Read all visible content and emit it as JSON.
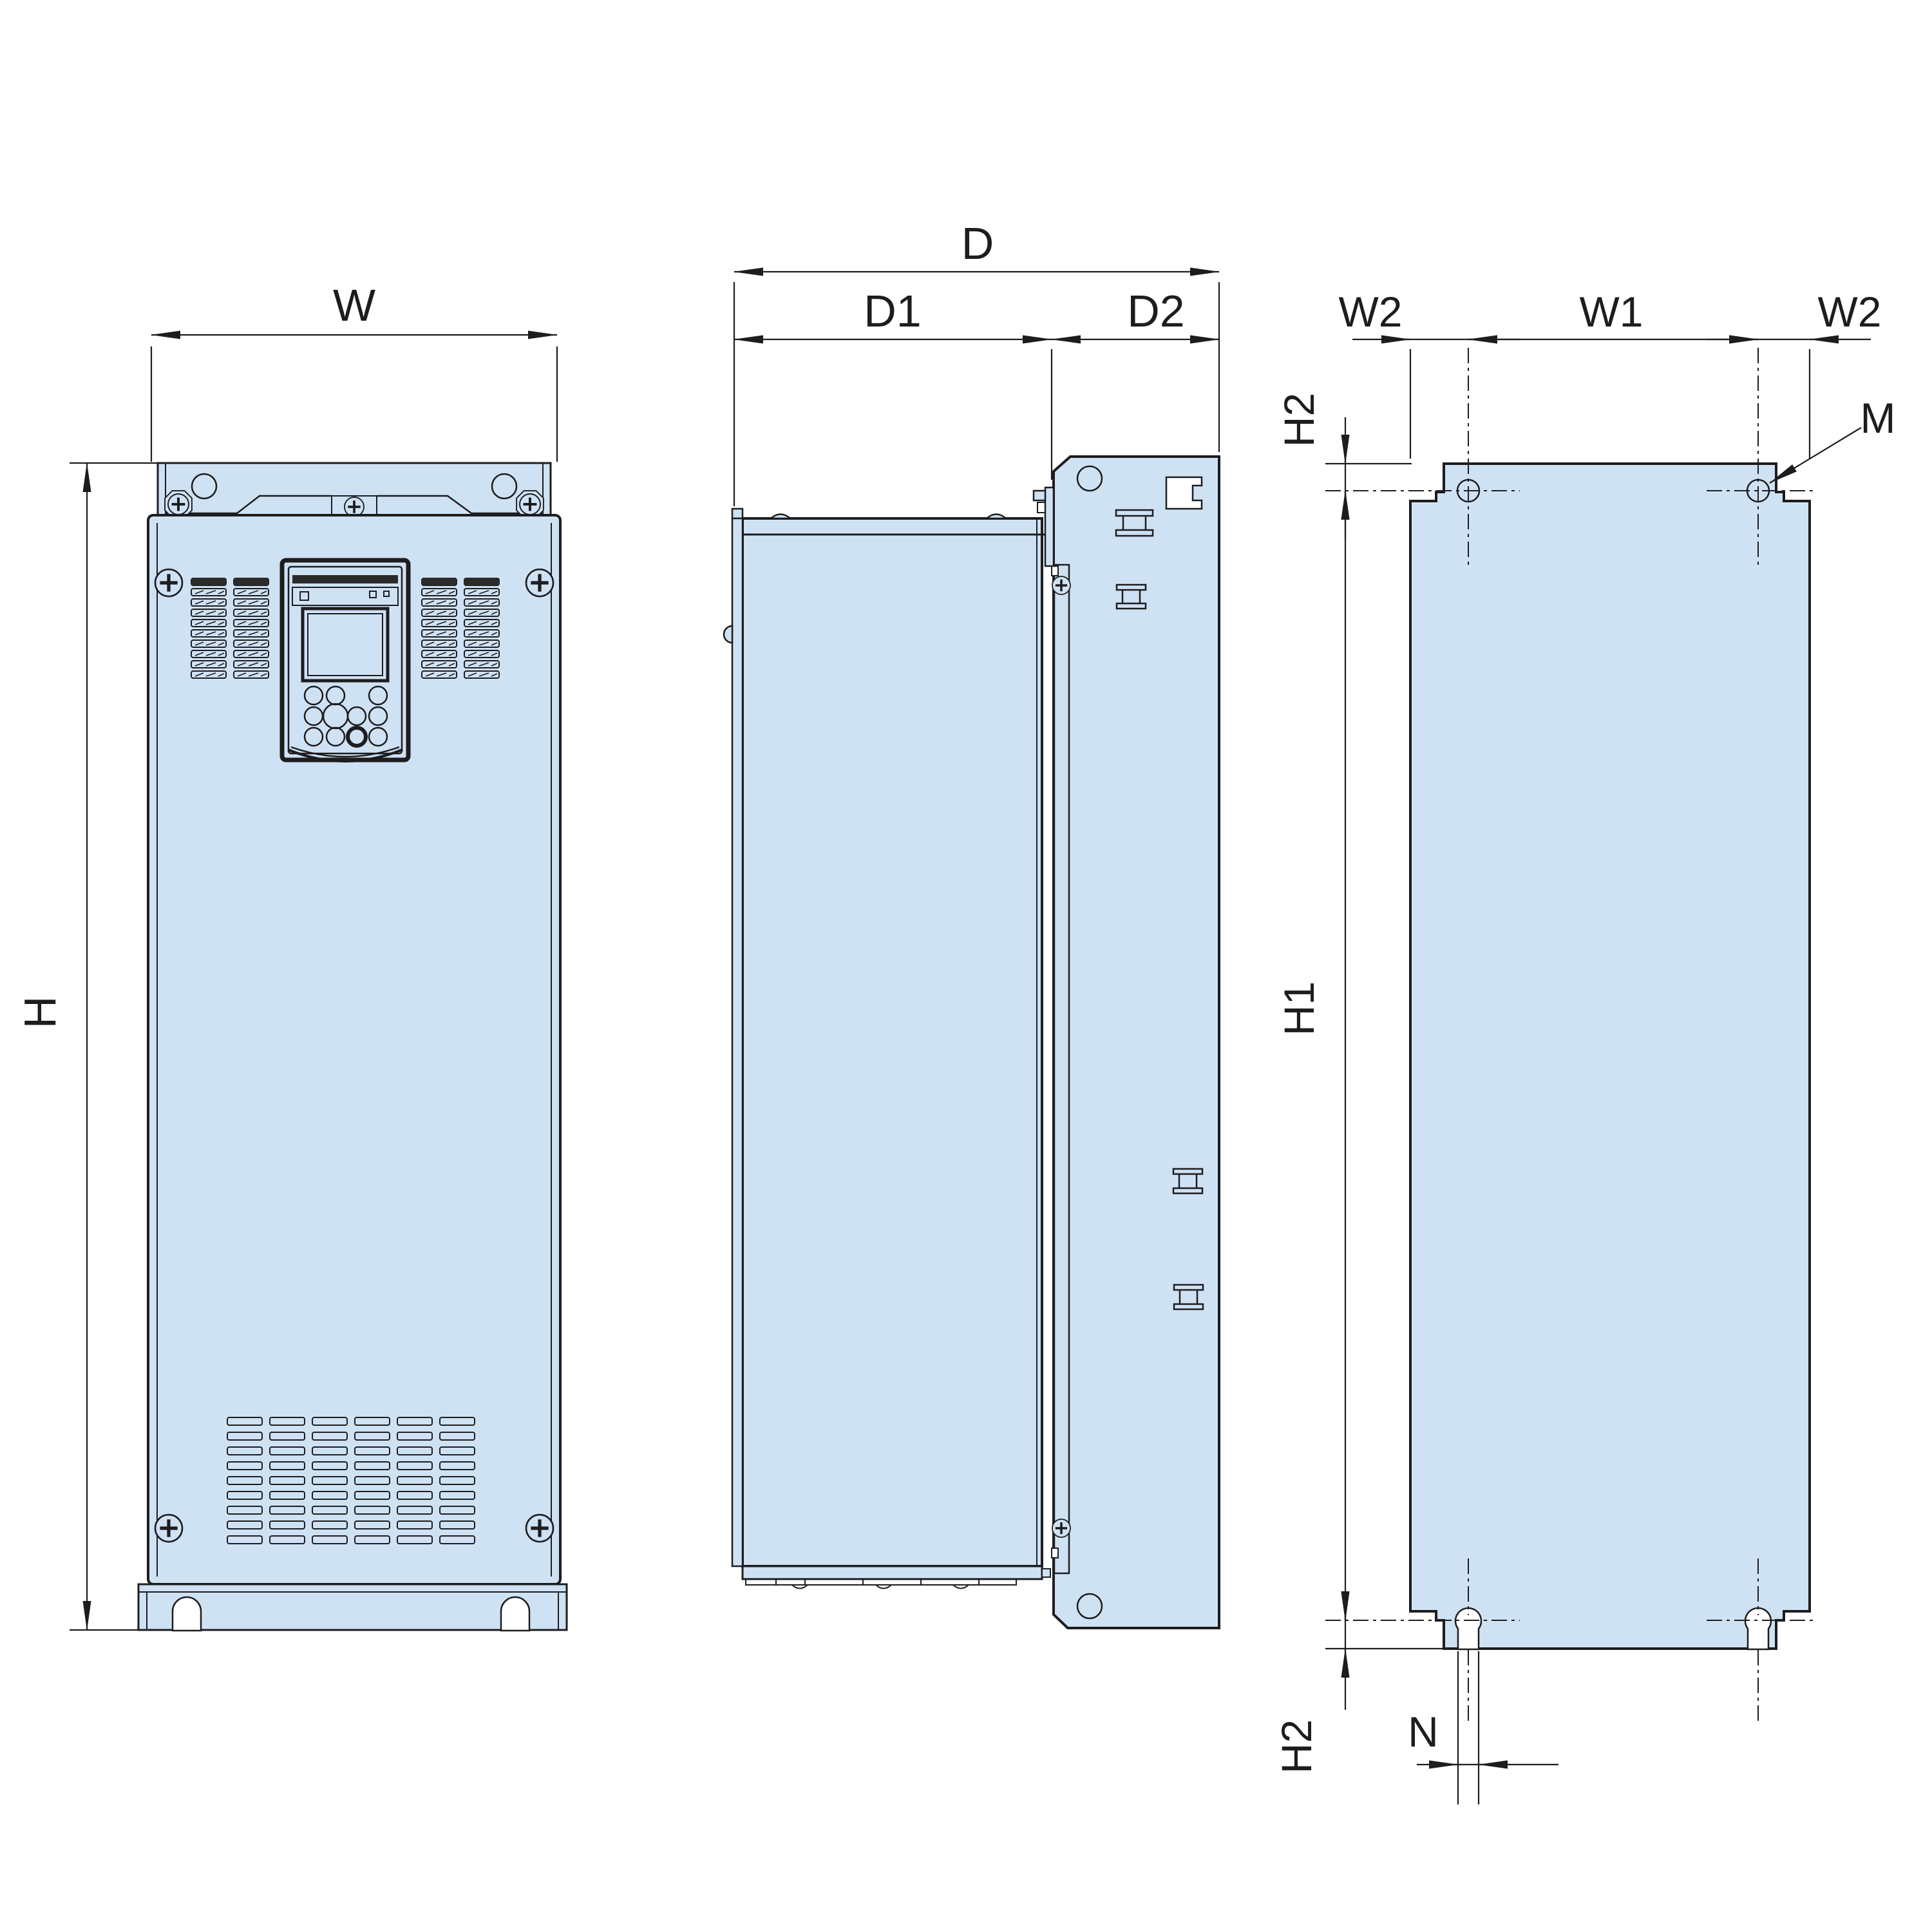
{
  "drawing": {
    "title": "inverter-drive-dimension-outline",
    "colors": {
      "line": "#1d1d1f",
      "panel_fill": "#cfe2f4",
      "dark_fill": "#2b2b2b",
      "background": "#ffffff"
    },
    "views": {
      "front": {
        "dims": {
          "width": "W",
          "height": "H"
        }
      },
      "side": {
        "dims": {
          "depth": "D",
          "depth_front": "D1",
          "depth_rear": "D2"
        }
      },
      "rear": {
        "dims": {
          "margin_left": "W2",
          "hole_span_horizontal": "W1",
          "margin_right": "W2",
          "margin_top": "H2",
          "hole_span_vertical": "H1",
          "margin_bottom": "H2",
          "mounting_hole": "M",
          "slot_width": "N"
        }
      }
    }
  }
}
